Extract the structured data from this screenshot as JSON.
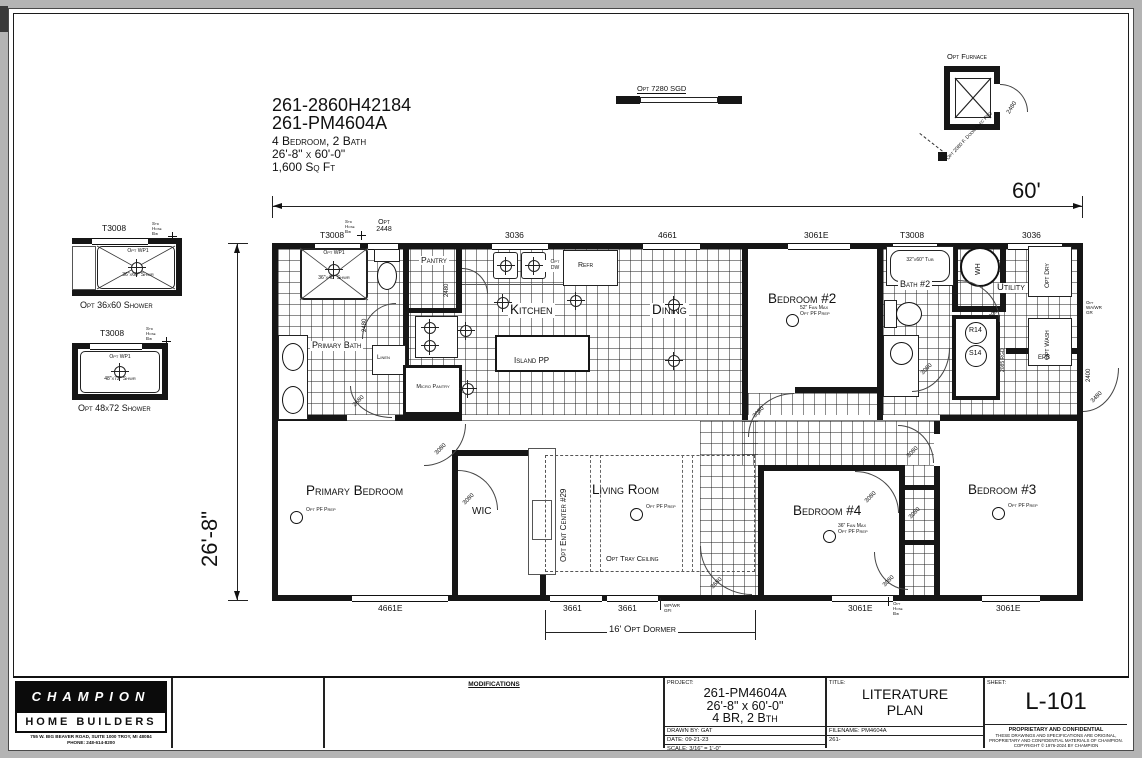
{
  "drawing": {
    "header": {
      "model1": "261-2860H42184",
      "model2": "261-PM4604A",
      "beds": "4 Bedroom, 2 Bath",
      "size": "26'-8\" x 60'-0\"",
      "area": "1,600 Sq Ft"
    },
    "dims": {
      "width": "60'",
      "depth": "26'-8\"",
      "dormer": "16' Opt Dormer"
    },
    "top": {
      "sgd": "Opt 7280 SGD",
      "furnace": "Opt Furnace",
      "furnace_door": "2480",
      "furnace_note": "Opt 2080 F. Door Elec Req"
    },
    "details": {
      "window": "T3008",
      "hose_bib": "Std Hose Bib",
      "wp": "Opt WP1",
      "s1_size": "36\"x60\" Shwr",
      "s1_caption": "Opt 36x60 Shower",
      "s2_size": "48\"x72\" Shwr",
      "s2_caption": "Opt 48x72 Shower"
    },
    "windows_top": [
      "T3008",
      "Opt 2448",
      "3036",
      "4661",
      "3061E",
      "T3008",
      "3036"
    ],
    "windows_bottom": [
      "4661E",
      "3661",
      "3661",
      "3061E",
      "3061E"
    ],
    "rooms": {
      "pantry": "Pantry",
      "kitchen": "Kitchen",
      "dining": "Dining",
      "primary_bath": "Primary Bath",
      "linen": "Linen",
      "micro_pantry": "Micro Pantry",
      "bedroom2": "Bedroom #2",
      "bath2": "Bath #2",
      "utility": "Utility",
      "primary_bedroom": "Primary Bedroom",
      "wic": "WIC",
      "living_room": "Living Room",
      "bedroom4": "Bedroom #4",
      "bedroom3": "Bedroom #3"
    },
    "fixtures": {
      "island": "Island PP",
      "tub": "32\"x60\" Tub",
      "main_shower": "36\"x48\" Shwr",
      "wp": "Opt WP1",
      "wh": "WH",
      "refr": "Refr",
      "opt_dw": "Opt DW",
      "opt_dry": "Opt Dry",
      "opt_wash": "Opt Wash",
      "r14": "R14",
      "s14": "S14",
      "epb": "EPB",
      "ent_center": "Opt Ent Center #29",
      "tray_ceiling": "Opt Tray Ceiling"
    },
    "notes": {
      "pf": "Opt PF Prep",
      "fan52": "52\" Fan Max",
      "fan36": "36\" Fan Max",
      "opt_hb": "Opt Hose Bib",
      "std_hb": "Std Hose Bib",
      "gfi": "WP/WR GFI",
      "wa_gr": "Opt WA/WR GR",
      "reg": "2085 RGD",
      "n2400": "2400"
    },
    "doors": {
      "bath_entry": "2480",
      "pantry": "2480",
      "mid": "2680",
      "pb": "3080",
      "wic": "3080",
      "bed2": "3080",
      "bath2": "3060",
      "utility": "3060",
      "ext_right": "3480",
      "ext_bottom": "3680",
      "bed4": "3080",
      "bed3": "3080",
      "closet": "3080",
      "hall": "3080"
    }
  },
  "titleblock": {
    "logo_top": "CHAMPION",
    "logo_bottom": "HOME BUILDERS",
    "address": "755 W. BIG BEAVER ROAD, SUITE 1000  TROY, MI  48084",
    "phone": "PHONE: 248-614-8200",
    "modifications": "MODIFICATIONS",
    "project_label": "PROJECT:",
    "project_model": "261-PM4604A",
    "project_size": "26'-8\" x 60'-0\"",
    "project_beds": "4 BR, 2 Bth",
    "drawn_by": "DRAWN BY: GAT",
    "date": "DATE: 09-21-23",
    "scale": "SCALE: 3/16\" = 1'-0\"",
    "title_label": "TITLE:",
    "title1": "LITERATURE",
    "title2": "PLAN",
    "filename": "FILENAME: PM4604A",
    "file2": "261-",
    "sheet_label": "SHEET:",
    "sheet": "L-101",
    "prop1": "PROPRIETARY AND CONFIDENTIAL",
    "prop2": "THESE DRAWINGS AND SPECIFICATIONS ARE ORIGINAL,",
    "prop3": "PROPRIETARY AND CONFIDENTIAL MATERIALS OF CHAMPION.",
    "prop4": "COPYRIGHT © 1976-2024 BY CHAMPION"
  }
}
